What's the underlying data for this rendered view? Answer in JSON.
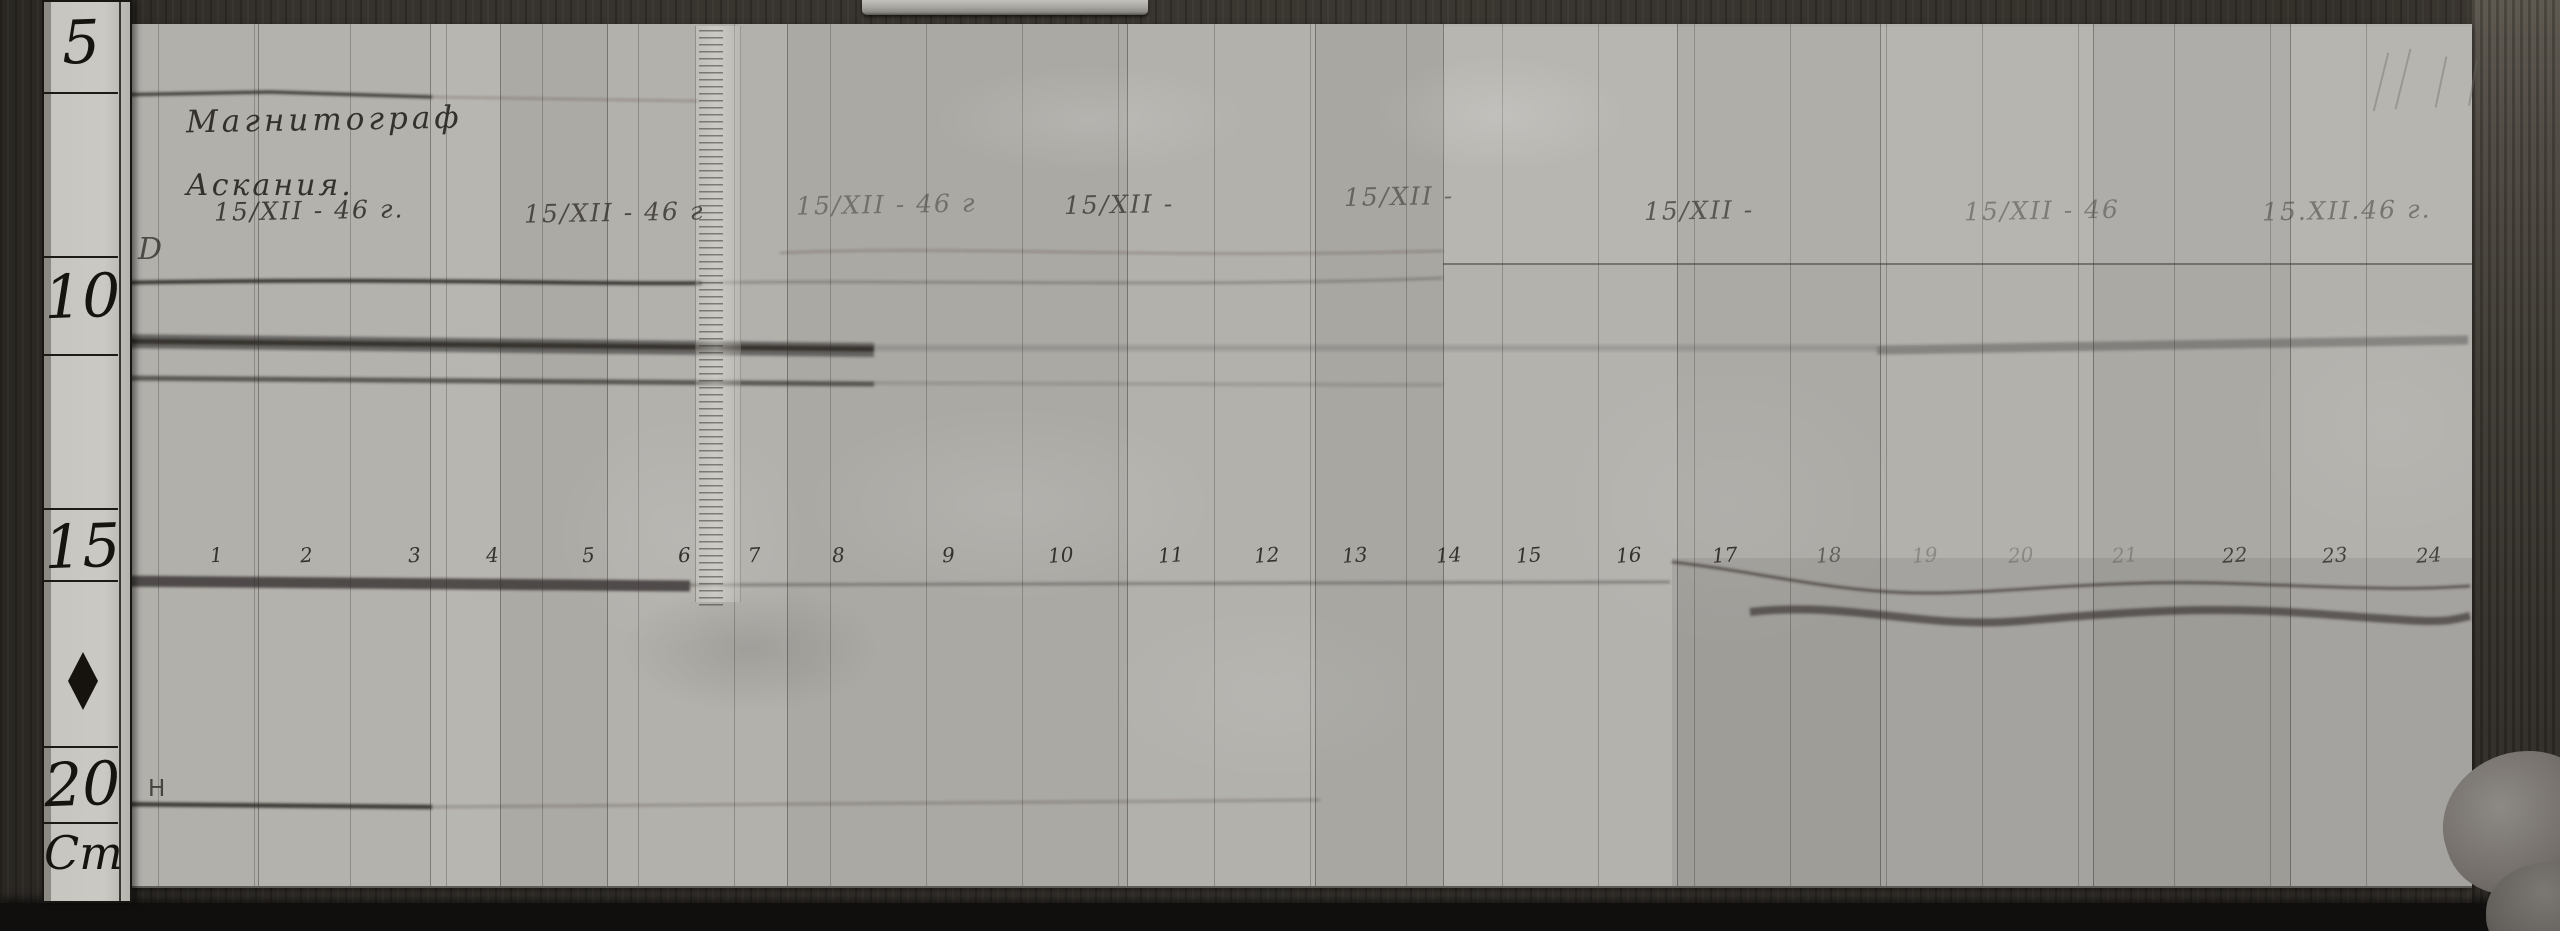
{
  "scene": {
    "description": "Black-and-white photograph of an Askania magnetograph record strip with a centimeter ruler, dated 15/XII 1946"
  },
  "ruler": {
    "unit": "Cm",
    "marks": [
      {
        "label": "5",
        "y": 6
      },
      {
        "label": "10",
        "y": 260
      },
      {
        "label": "15",
        "y": 510
      },
      {
        "label": "20",
        "y": 748
      }
    ]
  },
  "header": {
    "line1": "Магнитограф",
    "line2": "Аскания."
  },
  "trace_labels": {
    "top": "D",
    "bottom": "H"
  },
  "date_labels": [
    {
      "text": "15/XII - 46 г.",
      "x": 214,
      "y": 196,
      "o": 0.95
    },
    {
      "text": "15/XII - 46 г",
      "x": 524,
      "y": 198,
      "o": 0.85
    },
    {
      "text": "15/XII - 46 г",
      "x": 796,
      "y": 190,
      "o": 0.5
    },
    {
      "text": "15/XII -",
      "x": 1064,
      "y": 190,
      "o": 0.8
    },
    {
      "text": "15/XII -",
      "x": 1344,
      "y": 182,
      "o": 0.6
    },
    {
      "text": "15/XII -",
      "x": 1644,
      "y": 196,
      "o": 0.75
    },
    {
      "text": "15/XII - 46",
      "x": 1964,
      "y": 196,
      "o": 0.45
    },
    {
      "text": "15.XII.46 г.",
      "x": 2262,
      "y": 196,
      "o": 0.5
    }
  ],
  "hour_marks": [
    {
      "label": "1",
      "x": 210
    },
    {
      "label": "2",
      "x": 300
    },
    {
      "label": "3",
      "x": 408
    },
    {
      "label": "4",
      "x": 486
    },
    {
      "label": "5",
      "x": 582
    },
    {
      "label": "6",
      "x": 678
    },
    {
      "label": "7",
      "x": 748
    },
    {
      "label": "8",
      "x": 832
    },
    {
      "label": "9",
      "x": 942
    },
    {
      "label": "10",
      "x": 1048
    },
    {
      "label": "11",
      "x": 1158
    },
    {
      "label": "12",
      "x": 1254
    },
    {
      "label": "13",
      "x": 1342
    },
    {
      "label": "14",
      "x": 1436
    },
    {
      "label": "15",
      "x": 1516
    },
    {
      "label": "16",
      "x": 1616
    },
    {
      "label": "17",
      "x": 1712
    },
    {
      "label": "18",
      "x": 1816,
      "o": 0.6
    },
    {
      "label": "19",
      "x": 1912,
      "o": 0.3
    },
    {
      "label": "20",
      "x": 2008,
      "o": 0.3
    },
    {
      "label": "21",
      "x": 2112,
      "o": 0.3
    },
    {
      "label": "22",
      "x": 2222,
      "o": 0.85
    },
    {
      "label": "23",
      "x": 2322,
      "o": 0.85
    },
    {
      "label": "24",
      "x": 2416,
      "o": 0.85
    }
  ]
}
